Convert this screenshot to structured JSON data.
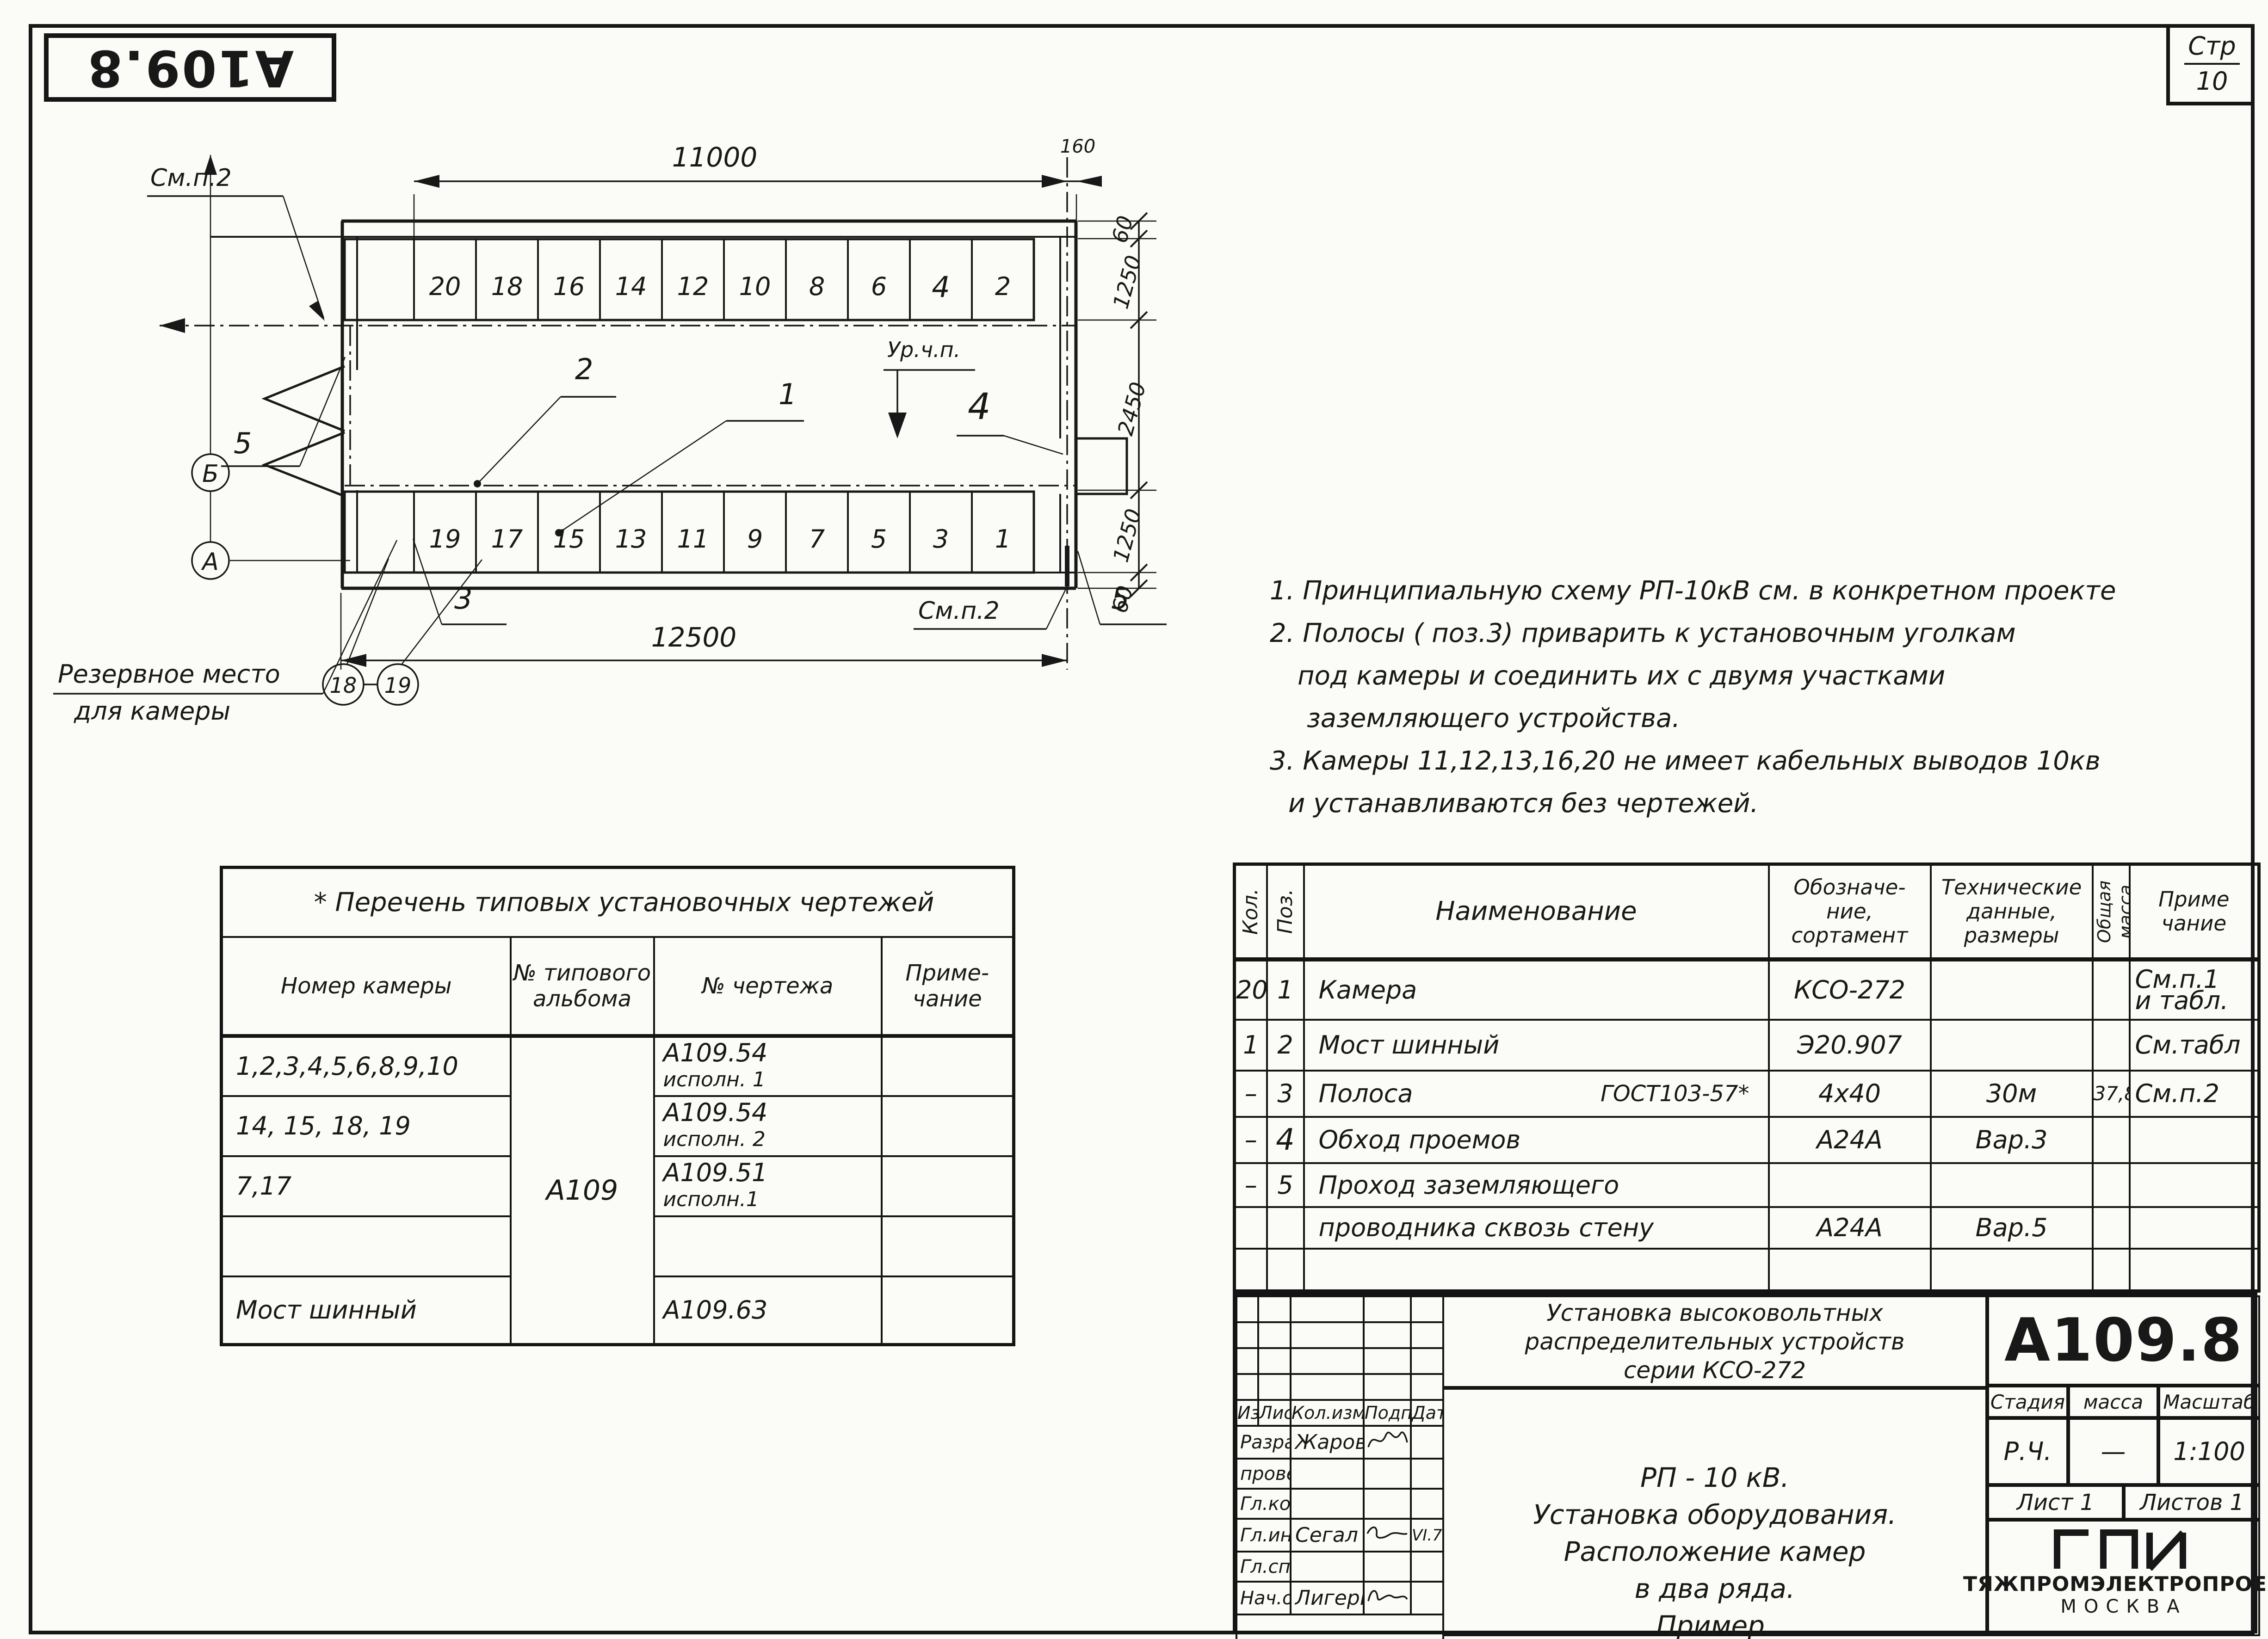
{
  "page": {
    "corner_stamp": "А109.8",
    "page_label": "Стр",
    "page_number": "10"
  },
  "plan": {
    "dims": {
      "top": "11000",
      "gap": "160",
      "bottom": "12500",
      "right": [
        "60",
        "1250",
        "2450",
        "1250",
        "60"
      ]
    },
    "top_row": [
      "20",
      "18",
      "16",
      "14",
      "12",
      "10",
      "8",
      "6",
      "4",
      "2"
    ],
    "bottom_row": [
      "19",
      "17",
      "15",
      "13",
      "11",
      "9",
      "7",
      "5",
      "3",
      "1"
    ],
    "labels": {
      "see_note_2_top": "См.п.2",
      "pos_5_top": "5",
      "pos_2": "2",
      "pos_1": "1",
      "floor_level": "Ур.ч.п.",
      "pos_4": "4",
      "axis_b": "Б",
      "axis_a": "А",
      "pos_3": "3",
      "reserve_line1": "Резервное место",
      "reserve_line2": "для камеры",
      "cam_18": "18",
      "cam_19": "19",
      "see_note_2_bottom": "См.п.2",
      "pos_5_bottom": "5"
    }
  },
  "notes": {
    "line1": "1. Принципиальную схему РП-10кВ см. в конкретном проекте",
    "line2": "2. Полосы ( поз.3) приварить к установочным уголкам",
    "line3": "под камеры и соединить их с двумя участками",
    "line4": "заземляющего устройства.",
    "line5": "3. Камеры 11,12,13,16,20 не имеет кабельных выводов 10кв",
    "line6": "и устанавливаются без чертежей."
  },
  "drawings_table": {
    "title": "* Перечень типовых установочных чертежей",
    "col_camera": "Номер камеры",
    "col_album_1": "№ типового",
    "col_album_2": "альбома",
    "col_drawing": "№ чертежа",
    "col_note_1": "Приме-",
    "col_note_2": "чание",
    "album": "А109",
    "rows": [
      {
        "cameras": "1,2,3,4,5,6,8,9,10",
        "drawing": "А109.54",
        "variant": "исполн. 1"
      },
      {
        "cameras": "14, 15, 18, 19",
        "drawing": "А109.54",
        "variant": "исполн. 2"
      },
      {
        "cameras": "7,17",
        "drawing": "А109.51",
        "variant": "исполн.1"
      },
      {
        "cameras": "",
        "drawing": "",
        "variant": ""
      },
      {
        "cameras": "Мост шинный",
        "drawing": "А109.63",
        "variant": ""
      }
    ]
  },
  "spec_table": {
    "col_qty": "Кол.",
    "col_pos": "Поз.",
    "col_name": "Наименование",
    "col_designation_1": "Обозначе-",
    "col_designation_2": "ние,",
    "col_designation_3": "сортамент",
    "col_tech_1": "Технические",
    "col_tech_2": "данные,",
    "col_tech_3": "размеры",
    "col_mass": "Общая масса",
    "col_note_1": "Приме",
    "col_note_2": "чание",
    "rows": [
      {
        "qty": "20",
        "pos": "1",
        "name": "Камера",
        "gost": "",
        "designation": "КСО-272",
        "tech": "",
        "mass": "",
        "note1": "См.п.1",
        "note2": "и табл."
      },
      {
        "qty": "1",
        "pos": "2",
        "name": "Мост шинный",
        "gost": "",
        "designation": "Э20.907",
        "tech": "",
        "mass": "",
        "note1": "См.табл",
        "note2": ""
      },
      {
        "qty": "–",
        "pos": "3",
        "name": "Полоса",
        "gost": "ГОСТ103-57*",
        "designation": "4х40",
        "tech": "30м",
        "mass": "37,8",
        "note1": "См.п.2",
        "note2": ""
      },
      {
        "qty": "–",
        "pos": "4",
        "name": "Обход проемов",
        "gost": "",
        "designation": "А24А",
        "tech": "Вар.3",
        "mass": "",
        "note1": "",
        "note2": ""
      },
      {
        "qty": "–",
        "pos": "5",
        "name": "Проход заземляющего",
        "gost": "",
        "designation": "",
        "tech": "",
        "mass": "",
        "note1": "",
        "note2": ""
      },
      {
        "qty": "",
        "pos": "",
        "name": "проводника сквозь стену",
        "gost": "",
        "designation": "А24А",
        "tech": "Вар.5",
        "mass": "",
        "note1": "",
        "note2": ""
      }
    ]
  },
  "title_block": {
    "project_line1": "Установка высоковольтных",
    "project_line2": "распределительных устройств",
    "project_line3": "серии КСО-272",
    "doc_number": "А109.8",
    "stage_label": "Стадия",
    "mass_label": "масса",
    "scale_label": "Масштаб",
    "stage": "Р.Ч.",
    "mass": "—",
    "scale": "1:100",
    "sheet": "Лист 1",
    "sheets": "Листов 1",
    "org_logo": "ГПИ",
    "org_name": "ТЯЖПРОМЭЛЕКТРОПРОЕК",
    "org_city": "МОСКВА",
    "subject_line1": "РП - 10 кВ.",
    "subject_line2": "Установка оборудования.",
    "subject_line3": "Расположение камер",
    "subject_line4": "в два ряда.",
    "subject_line5": "Пример.",
    "rev_headers": {
      "izm": "Изм",
      "list": "Лист",
      "kol": "Кол.изм.",
      "podp": "Подп.",
      "data": "Дата"
    },
    "roles": [
      {
        "role": "Разраб.",
        "name": "Жарова",
        "date": ""
      },
      {
        "role": "провер.",
        "name": "",
        "date": ""
      },
      {
        "role": "Гл.констр.",
        "name": "",
        "date": ""
      },
      {
        "role": "Гл.инж.пр.",
        "name": "Сегал",
        "date": "VI.74"
      },
      {
        "role": "Гл.спец.",
        "name": "",
        "date": ""
      },
      {
        "role": "Нач.отд.",
        "name": "Лигерман",
        "date": ""
      }
    ]
  }
}
